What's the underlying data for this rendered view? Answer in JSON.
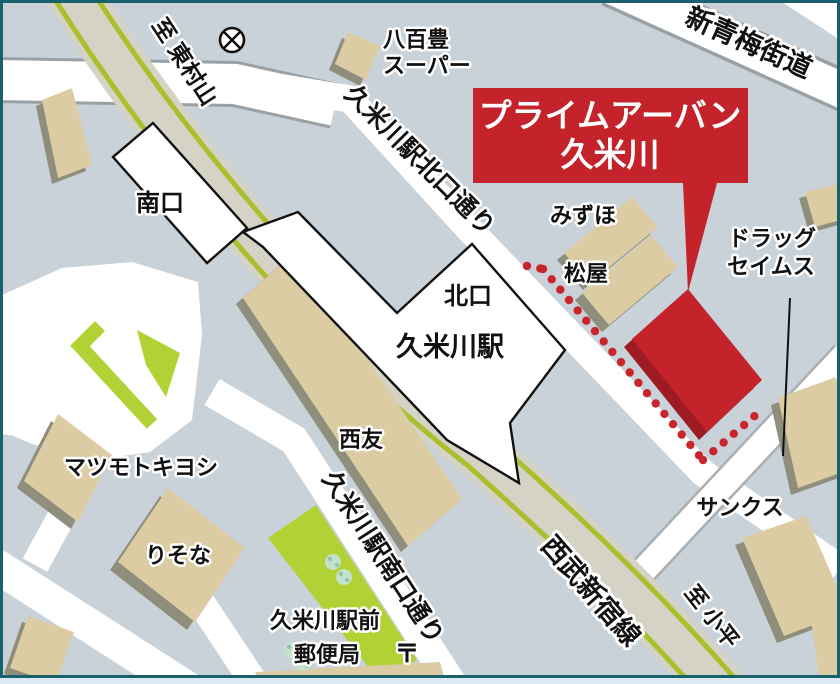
{
  "map": {
    "callout": {
      "line1": "プライムアーバン",
      "line2": "久米川",
      "color": "#c5232b",
      "shadow_color": "#9e1b23"
    },
    "station": {
      "name": "久米川駅",
      "north_exit": "北口",
      "south_exit": "南口"
    },
    "railway": {
      "name": "西武新宿線",
      "to_north": "至 東村山",
      "to_south": "至 小平",
      "line_color": "#a9c02c",
      "bed_color": "#d5d2c6"
    },
    "roads": {
      "shin_ome_kaido": "新青梅街道",
      "kitaguchi_dori": "久米川駅北口通り",
      "minamiguchi_dori": "久米川駅南口通り"
    },
    "places": {
      "yaohotoyo_line1": "八百豊",
      "yaohotoyo_line2": "スーパー",
      "mizuho": "みずほ",
      "matsuya": "松屋",
      "drug_line1": "ドラッグ",
      "drug_line2": "セイムス",
      "seiyu": "西友",
      "matsumotokiyoshi": "マツモトキヨシ",
      "risona": "りそな",
      "post_office_line1": "久米川駅前",
      "post_office_line2": "郵便局",
      "postal_mark": "〒",
      "sunkus": "サンクス"
    },
    "icons": {
      "police_station": "police-station-symbol",
      "route_dots_color": "#c9252d"
    },
    "colors": {
      "background": "#c9d2d9",
      "road": "#ffffff",
      "road_edge": "#9aa1a5",
      "building": "#dccca4",
      "building_shadow": "#8f8d7c",
      "green": "#b2d134",
      "tree": "#c5e2cf",
      "frame": "#19616c",
      "station_outline": "#111111"
    }
  }
}
